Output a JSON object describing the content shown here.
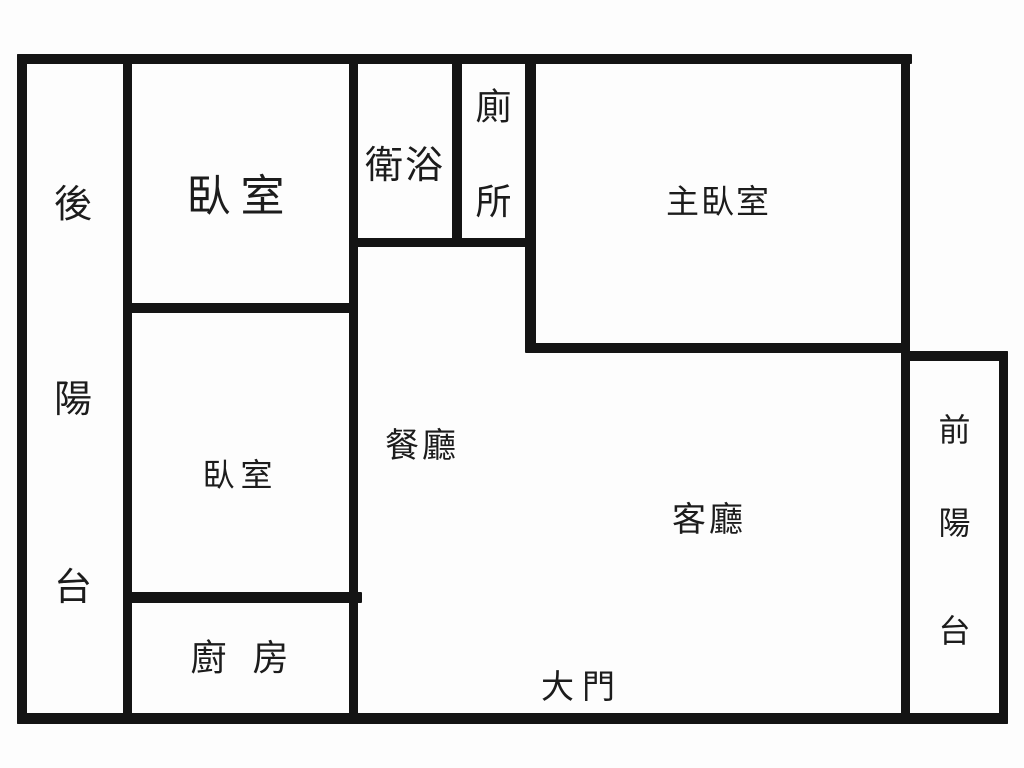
{
  "title": "apartment floor plan",
  "colors": {
    "wall": "#141414",
    "background": "#fdfdfd",
    "text": "#1c1c1c"
  },
  "rooms": {
    "rear_balcony": {
      "name": "後陽台",
      "chars": [
        "後",
        "陽",
        "台"
      ]
    },
    "bedroom1": {
      "label": "臥室"
    },
    "bedroom2": {
      "label": "臥室"
    },
    "kitchen": {
      "label": "廚房"
    },
    "bathroom": {
      "label": "衛浴"
    },
    "toilet": {
      "name": "廁所",
      "chars": [
        "廁",
        "所"
      ]
    },
    "master_bedroom": {
      "label": "主臥室"
    },
    "dining_room": {
      "label": "餐廳"
    },
    "living_room": {
      "label": "客廳"
    },
    "main_door": {
      "label": "大門"
    },
    "front_balcony": {
      "name": "前陽台",
      "chars": [
        "前",
        "陽",
        "台"
      ]
    }
  }
}
